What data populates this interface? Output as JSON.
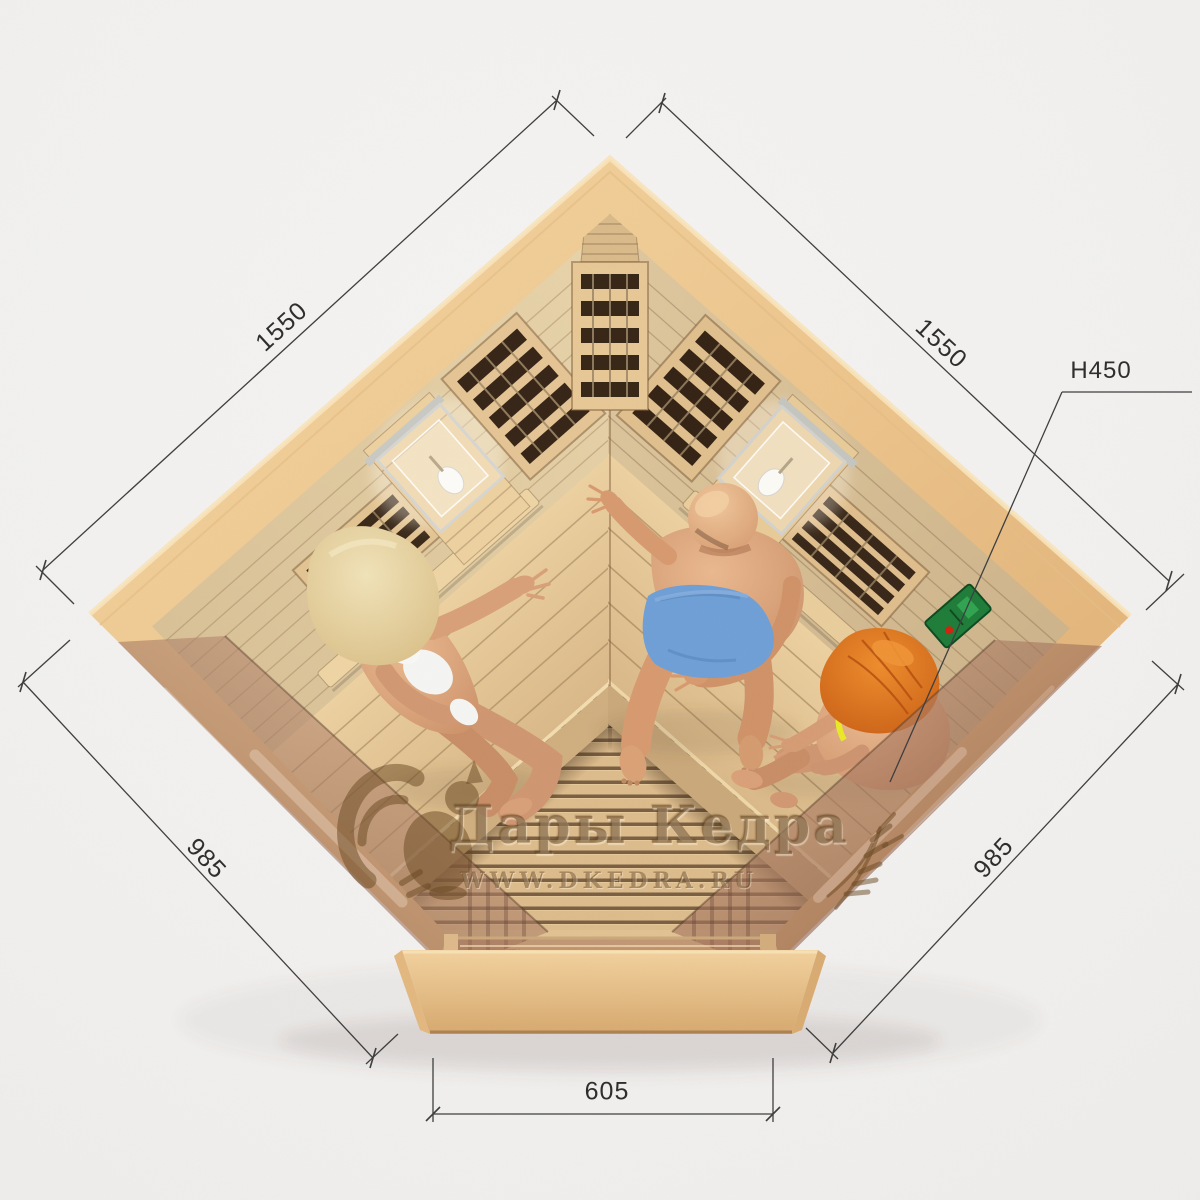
{
  "dimensions": {
    "top_left": "1550",
    "top_right": "1550",
    "height_label": "H450",
    "bottom_left": "985",
    "bottom_right": "985",
    "front_width": "605"
  },
  "watermark": {
    "brand": "Дары Кедра",
    "website": "WWW.DKEDRA.RU",
    "logo_icon": "squirrel-icon",
    "decor_icon": "wheat-icon"
  },
  "colors": {
    "page_bg": "#f1f0ee",
    "dim_line": "#3f3f3f",
    "dim_text": "#2e2e2e",
    "wood_light": "#f2d29e",
    "wood_dark": "#dcae74",
    "glass_tint": "#a97a60",
    "watermark": "rgba(104,70,32,0.5)",
    "panel_green": "#1f7c39",
    "skin": "#d79c74",
    "floor_gap": "#6b5034"
  }
}
